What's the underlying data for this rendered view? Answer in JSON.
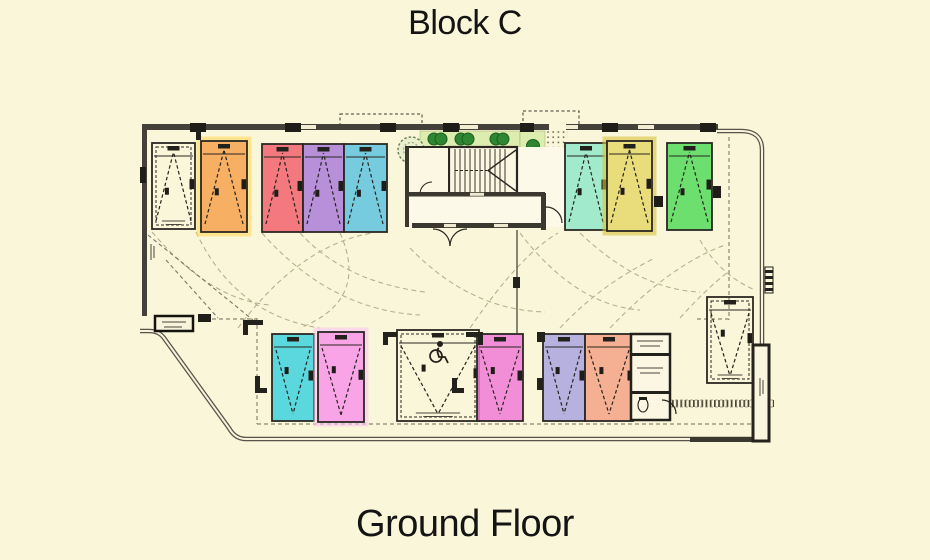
{
  "page": {
    "title": "Block C",
    "subtitle": "Ground Floor",
    "background": "#FAF6D9",
    "text_color": "#141414"
  },
  "plan": {
    "wall_color": "#3b382f",
    "column_color": "#1f1d18",
    "dash_color": "#8d8672",
    "arc_color": "#b5ac8d",
    "landscape_green": "#DDECAF",
    "bush_green": "#2F8632",
    "space_outline": "#2a2722",
    "spaces": [
      {
        "id": "p1",
        "row": "top",
        "x": 152,
        "y": 143,
        "w": 43,
        "h": 86,
        "fill": "none",
        "dir": "up",
        "label_stub": true,
        "color_name": "unassigned"
      },
      {
        "id": "p2",
        "row": "top",
        "x": 201,
        "y": 141,
        "w": 46,
        "h": 91,
        "fill": "#F6A24E",
        "glow": "#FFD95A",
        "dir": "up",
        "color_name": "orange"
      },
      {
        "id": "p3",
        "row": "top",
        "x": 262,
        "y": 144,
        "w": 41,
        "h": 88,
        "fill": "#F2636E",
        "dir": "up",
        "color_name": "red"
      },
      {
        "id": "p4",
        "row": "top",
        "x": 303,
        "y": 144,
        "w": 41,
        "h": 88,
        "fill": "#AA7ED8",
        "dir": "up",
        "color_name": "purple"
      },
      {
        "id": "p5",
        "row": "top",
        "x": 344,
        "y": 144,
        "w": 43,
        "h": 88,
        "fill": "#5FC3DF",
        "dir": "up",
        "color_name": "blue"
      },
      {
        "id": "p6",
        "row": "top",
        "x": 565,
        "y": 143,
        "w": 42,
        "h": 87,
        "fill": "#90E8C9",
        "dir": "up",
        "color_name": "mint"
      },
      {
        "id": "p7",
        "row": "top",
        "x": 607,
        "y": 141,
        "w": 45,
        "h": 90,
        "fill": "#E4D76A",
        "glow": "#D9C53A",
        "dir": "up",
        "color_name": "yellow"
      },
      {
        "id": "p8",
        "row": "top",
        "x": 667,
        "y": 143,
        "w": 45,
        "h": 87,
        "fill": "#52DB5C",
        "dir": "up",
        "color_name": "green"
      },
      {
        "id": "p9",
        "row": "bottom",
        "x": 272,
        "y": 334,
        "w": 42,
        "h": 87,
        "fill": "#3ED2DE",
        "dir": "down",
        "color_name": "cyan"
      },
      {
        "id": "p10",
        "row": "bottom",
        "x": 318,
        "y": 332,
        "w": 46,
        "h": 90,
        "fill": "#F795E7",
        "glow": "#FBC7F2",
        "dir": "down",
        "color_name": "pink"
      },
      {
        "id": "p11",
        "row": "bottom",
        "x": 397,
        "y": 330,
        "w": 82,
        "h": 91,
        "fill": "none",
        "dir": "down",
        "icon": "wheelchair",
        "label_stub": true,
        "color_name": "accessible"
      },
      {
        "id": "p12",
        "row": "bottom",
        "x": 477,
        "y": 334,
        "w": 46,
        "h": 87,
        "fill": "#F07BD6",
        "dir": "down",
        "color_name": "magenta"
      },
      {
        "id": "p13",
        "row": "bottom",
        "x": 543,
        "y": 334,
        "w": 42,
        "h": 87,
        "fill": "#A9A5DE",
        "dir": "down",
        "color_name": "lavender"
      },
      {
        "id": "p14",
        "row": "bottom",
        "x": 585,
        "y": 334,
        "w": 48,
        "h": 87,
        "fill": "#F3A285",
        "dir": "down",
        "color_name": "salmon"
      },
      {
        "id": "p15",
        "row": "bottom",
        "x": 707,
        "y": 297,
        "w": 46,
        "h": 86,
        "fill": "none",
        "dir": "down",
        "label_stub": true,
        "color_name": "unassigned"
      }
    ]
  }
}
